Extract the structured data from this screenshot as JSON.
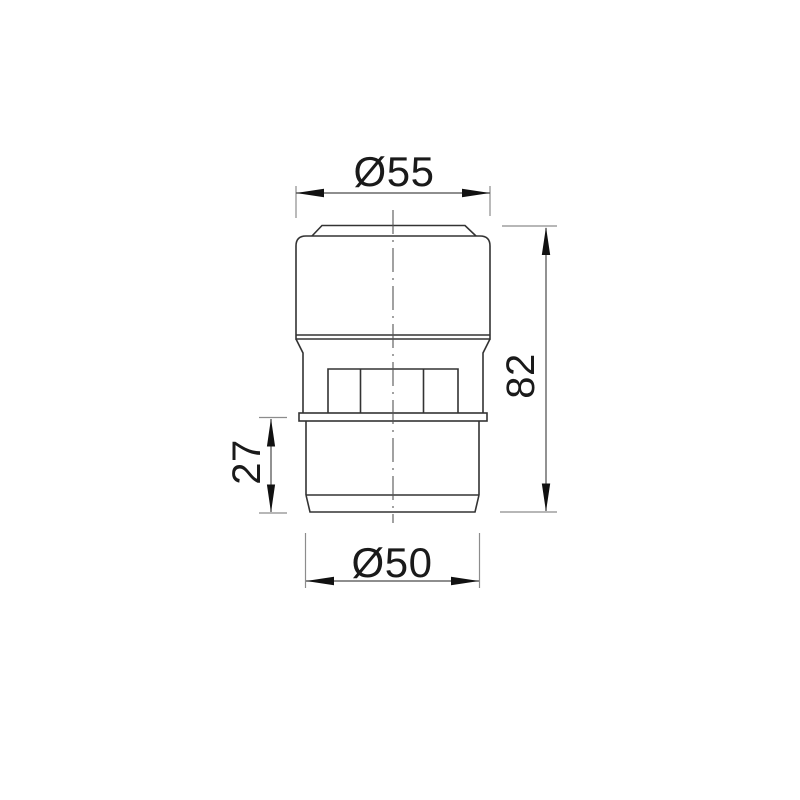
{
  "drawing": {
    "type": "engineering-dimension-drawing",
    "labels": {
      "top_diameter": "Ø55",
      "overall_height": "82",
      "lower_section_height": "27",
      "bottom_diameter": "Ø50"
    },
    "values": {
      "top_diameter_mm": 55,
      "overall_height_mm": 82,
      "lower_section_height_mm": 27,
      "bottom_diameter_mm": 50
    },
    "colors": {
      "background": "#ffffff",
      "object_line": "#333333",
      "dimension_line": "#4a4a4a",
      "extension_line": "#8c8c8c",
      "arrow": "#111111",
      "centerline": "#555555",
      "text": "#1a1a1a"
    }
  }
}
